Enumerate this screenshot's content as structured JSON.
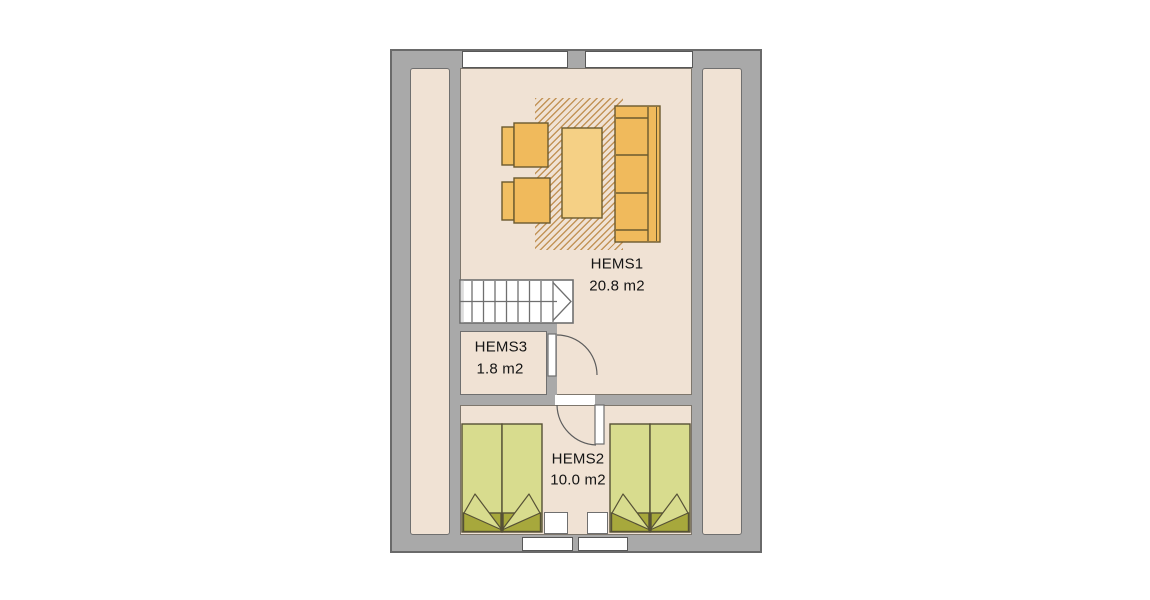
{
  "floor_plan": {
    "rooms": [
      {
        "id": "hems1",
        "name": "HEMS1",
        "area": "20.8 m2"
      },
      {
        "id": "hems2",
        "name": "HEMS2",
        "area": "10.0 m2"
      },
      {
        "id": "hems3",
        "name": "HEMS3",
        "area": "1.8 m2"
      }
    ],
    "colors": {
      "wall": "#a9a9a9",
      "wall_outline": "#6a6a6a",
      "floor": "#f0e2d4",
      "furniture_orange": "#f0ba5c",
      "coffee_table_light": "#f5d085",
      "bed_green": "#d8dc8e",
      "bed_foot_olive": "#a7a83c",
      "rug_hatch": "#be8c4b"
    },
    "features": [
      "staircase",
      "rug",
      "sofa",
      "armchair",
      "armchair",
      "coffee-table",
      "double-bed",
      "double-bed",
      "nightstand",
      "nightstand",
      "door",
      "door",
      "window",
      "window",
      "window",
      "window"
    ]
  }
}
